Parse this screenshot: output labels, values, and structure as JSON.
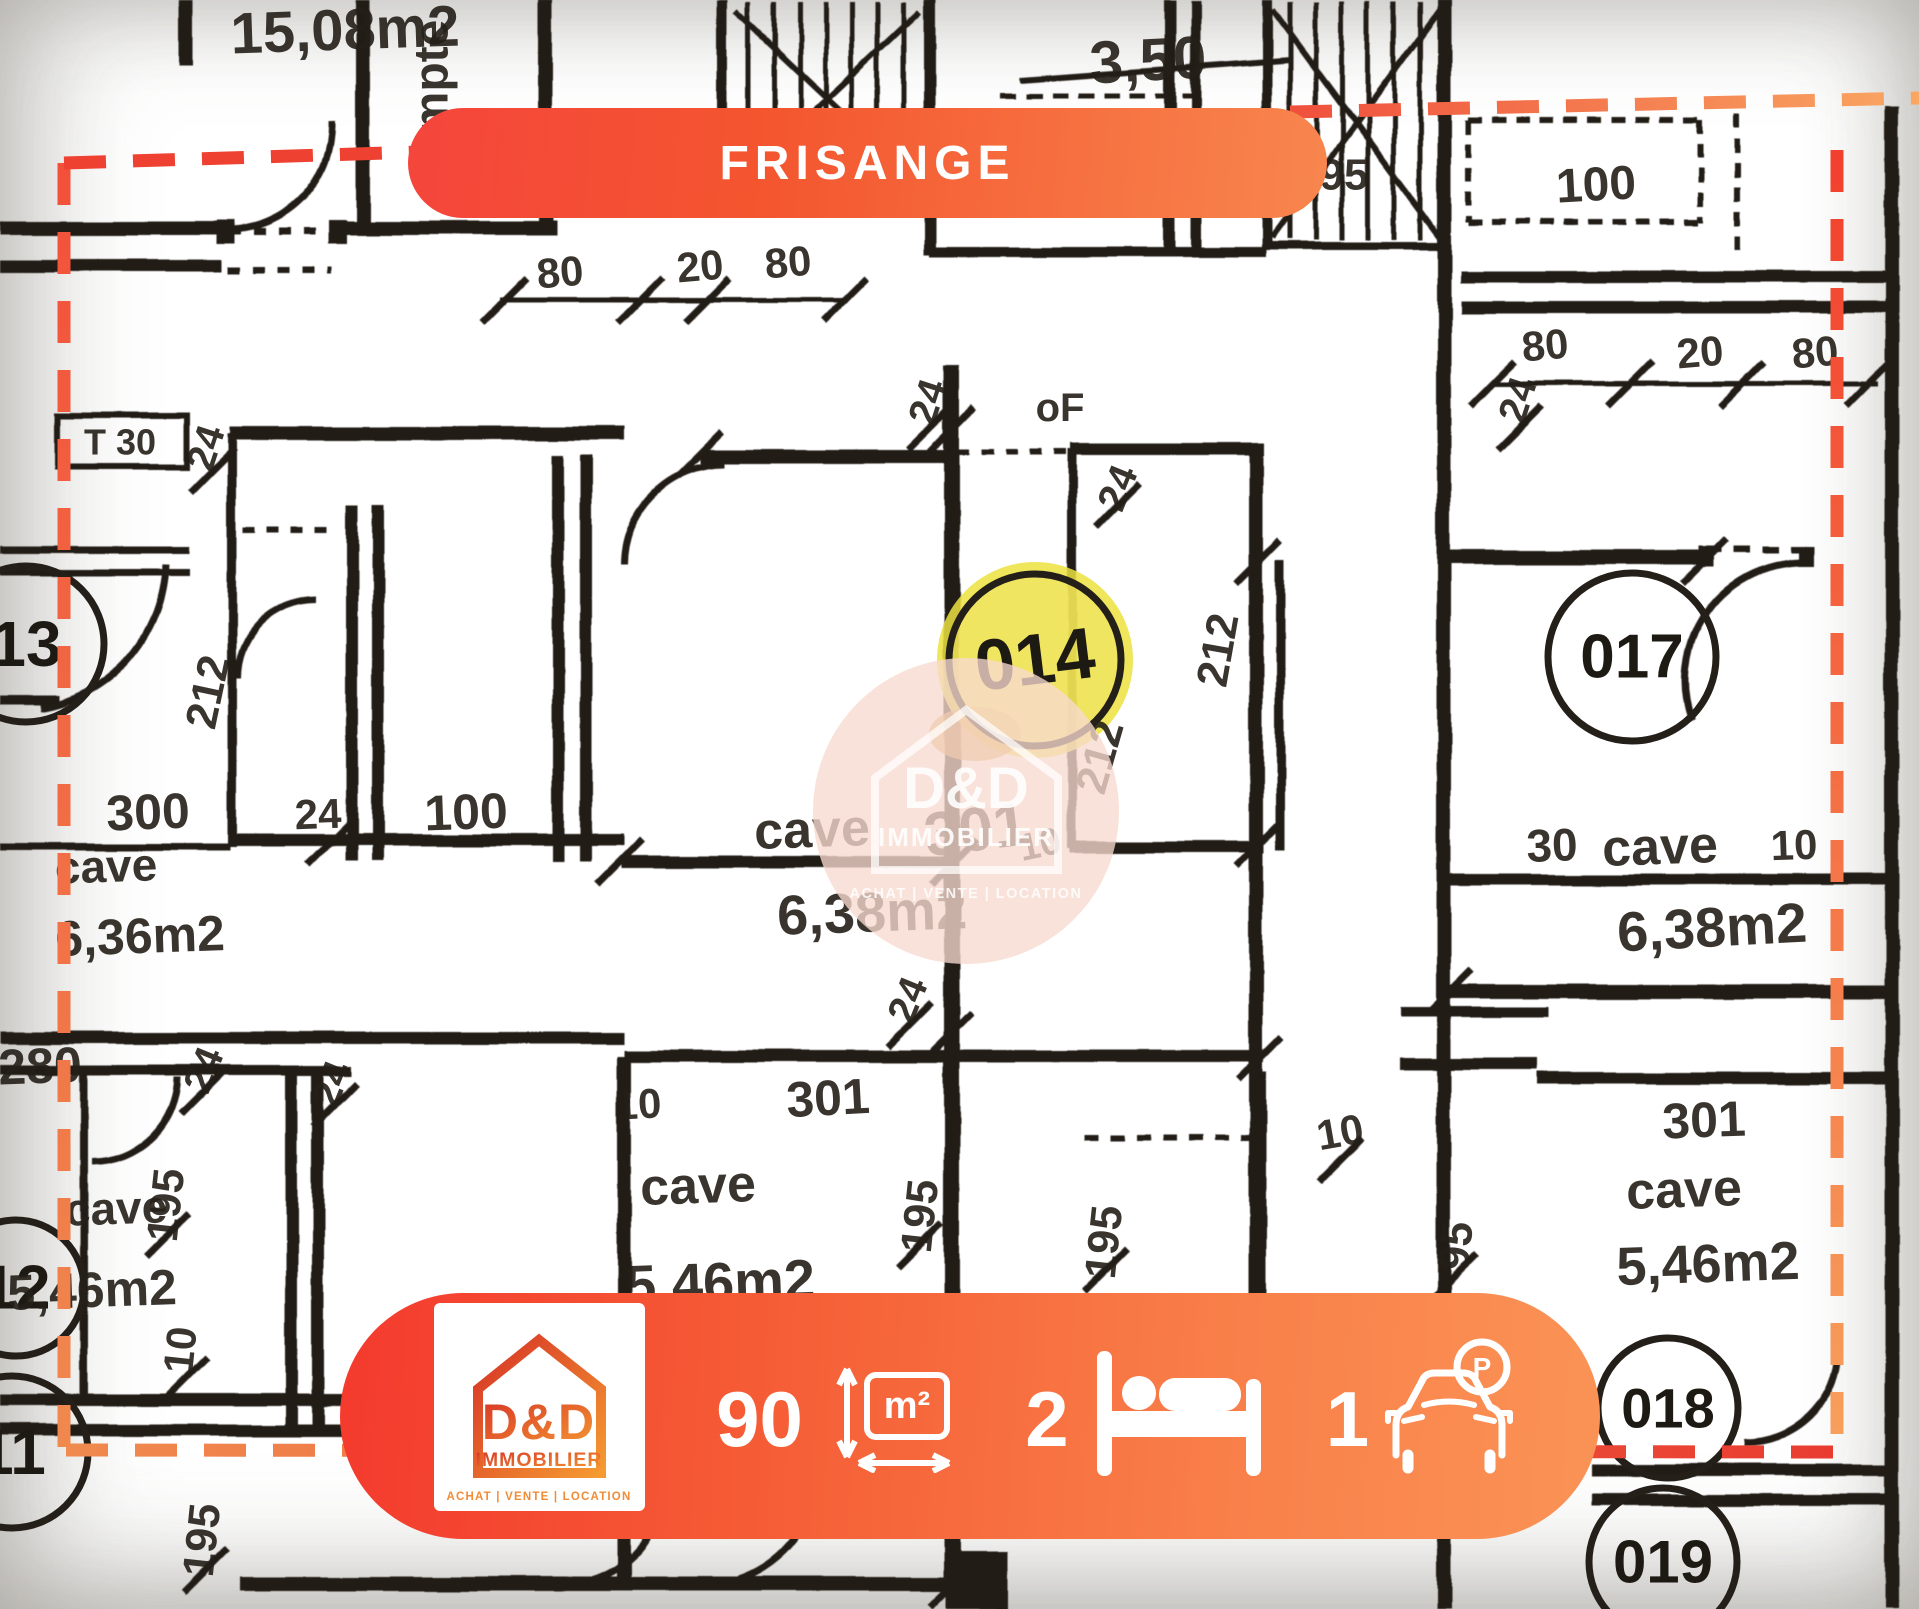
{
  "location_banner": {
    "label": "FRISANGE"
  },
  "property_stats": {
    "area_value": "90",
    "area_unit": "m²",
    "bedrooms_value": "2",
    "parking_value": "1",
    "parking_badge": "P"
  },
  "watermark": {
    "brand": "D&D",
    "brand_sub": "IMMOBILIER",
    "tagline": "ACHAT  |  VENTE  |  LOCATION"
  },
  "agency_card": {
    "brand": "D&D",
    "brand_sub": "IMMOBILIER",
    "tagline": "ACHAT  |  VENTE  |  LOCATION"
  },
  "colors": {
    "accent_red": "#f4392d",
    "accent_orange": "#f8854d",
    "highlight_yellow": "#ece23f",
    "paper": "#ded9cd",
    "ink": "#241f18",
    "dash_red": "#ee4132",
    "dash_orange": "#f79c5c"
  },
  "floor_plan": {
    "room_circles": [
      {
        "label": "13",
        "cx": 26,
        "cy": 644,
        "r": 78,
        "ts": 64
      },
      {
        "label": "12",
        "cx": 16,
        "cy": 1288,
        "r": 68,
        "ts": 62
      },
      {
        "label": "11",
        "cx": 12,
        "cy": 1452,
        "r": 76,
        "ts": 64
      },
      {
        "label": "014",
        "cx": 1035,
        "cy": 660,
        "r": 86,
        "ts": 72,
        "rot": -7,
        "highlight": true
      },
      {
        "label": "017",
        "cx": 1632,
        "cy": 657,
        "r": 84,
        "ts": 62
      },
      {
        "label": "018",
        "cx": 1668,
        "cy": 1408,
        "r": 70,
        "ts": 56
      },
      {
        "label": "019",
        "cx": 1663,
        "cy": 1562,
        "r": 74,
        "ts": 60
      }
    ],
    "labels": [
      {
        "t": "15,08m2",
        "x": 345,
        "y": 30,
        "s": 58,
        "r": -2
      },
      {
        "t": "compte",
        "x": 432,
        "y": 105,
        "s": 48,
        "r": -90
      },
      {
        "t": "3,50",
        "x": 1148,
        "y": 60,
        "s": 60,
        "r": -3
      },
      {
        "t": "95",
        "x": 1344,
        "y": 175,
        "s": 44,
        "r": 0
      },
      {
        "t": "100",
        "x": 1596,
        "y": 185,
        "s": 48,
        "r": -3
      },
      {
        "t": "80",
        "x": 560,
        "y": 272,
        "s": 42,
        "r": -5
      },
      {
        "t": "20",
        "x": 700,
        "y": 266,
        "s": 42,
        "r": -5
      },
      {
        "t": "80",
        "x": 788,
        "y": 262,
        "s": 42,
        "r": -5
      },
      {
        "t": "80",
        "x": 1545,
        "y": 345,
        "s": 42,
        "r": -5
      },
      {
        "t": "20",
        "x": 1700,
        "y": 352,
        "s": 42,
        "r": -5
      },
      {
        "t": "80",
        "x": 1815,
        "y": 352,
        "s": 42,
        "r": -5
      },
      {
        "t": "T 30",
        "x": 120,
        "y": 442,
        "s": 36,
        "r": 0
      },
      {
        "t": "24",
        "x": 206,
        "y": 448,
        "s": 40,
        "r": -72
      },
      {
        "t": "24",
        "x": 928,
        "y": 402,
        "s": 40,
        "r": -72
      },
      {
        "t": "oF",
        "x": 1060,
        "y": 408,
        "s": 40,
        "r": 0
      },
      {
        "t": "24",
        "x": 1118,
        "y": 488,
        "s": 40,
        "r": -68
      },
      {
        "t": "24",
        "x": 1518,
        "y": 400,
        "s": 40,
        "r": -72
      },
      {
        "t": "212",
        "x": 208,
        "y": 692,
        "s": 44,
        "r": -78
      },
      {
        "t": "212",
        "x": 1100,
        "y": 757,
        "s": 44,
        "r": -74
      },
      {
        "t": "212",
        "x": 1218,
        "y": 650,
        "s": 44,
        "r": -80
      },
      {
        "t": "300",
        "x": 148,
        "y": 812,
        "s": 50,
        "r": -2
      },
      {
        "t": "24",
        "x": 318,
        "y": 814,
        "s": 42,
        "r": -2
      },
      {
        "t": "100",
        "x": 466,
        "y": 812,
        "s": 50,
        "r": -2
      },
      {
        "t": "cave",
        "x": 812,
        "y": 830,
        "s": 52,
        "r": -2
      },
      {
        "t": "301",
        "x": 976,
        "y": 830,
        "s": 62,
        "r": -7
      },
      {
        "t": "10",
        "x": 1040,
        "y": 845,
        "s": 38,
        "r": -12
      },
      {
        "t": "6,38m2",
        "x": 872,
        "y": 912,
        "s": 56,
        "r": -2
      },
      {
        "t": "cave",
        "x": 106,
        "y": 866,
        "s": 46,
        "r": -2
      },
      {
        "t": "6,36m2",
        "x": 140,
        "y": 936,
        "s": 50,
        "r": -2
      },
      {
        "t": "30",
        "x": 1552,
        "y": 845,
        "s": 46,
        "r": -2
      },
      {
        "t": "cave",
        "x": 1660,
        "y": 847,
        "s": 52,
        "r": -2
      },
      {
        "t": "10",
        "x": 1794,
        "y": 845,
        "s": 42,
        "r": -2
      },
      {
        "t": "6,38m2",
        "x": 1712,
        "y": 927,
        "s": 56,
        "r": -3
      },
      {
        "t": "280",
        "x": 40,
        "y": 1066,
        "s": 50,
        "r": -2
      },
      {
        "t": "24",
        "x": 204,
        "y": 1070,
        "s": 40,
        "r": -68
      },
      {
        "t": "24",
        "x": 332,
        "y": 1084,
        "s": 40,
        "r": -68
      },
      {
        "t": "24",
        "x": 908,
        "y": 1000,
        "s": 40,
        "r": -68
      },
      {
        "t": "10",
        "x": 638,
        "y": 1104,
        "s": 42,
        "r": -3
      },
      {
        "t": "301",
        "x": 828,
        "y": 1098,
        "s": 50,
        "r": -3
      },
      {
        "t": "10",
        "x": 1340,
        "y": 1132,
        "s": 42,
        "r": -10
      },
      {
        "t": "cave",
        "x": 698,
        "y": 1186,
        "s": 52,
        "r": -2
      },
      {
        "t": "195",
        "x": 920,
        "y": 1216,
        "s": 44,
        "r": -84
      },
      {
        "t": "5,46m2",
        "x": 720,
        "y": 1282,
        "s": 56,
        "r": -2
      },
      {
        "t": "195",
        "x": 1104,
        "y": 1242,
        "s": 44,
        "r": -84
      },
      {
        "t": "95",
        "x": 1456,
        "y": 1246,
        "s": 44,
        "r": -84
      },
      {
        "t": "301",
        "x": 1704,
        "y": 1120,
        "s": 50,
        "r": -2
      },
      {
        "t": "cave",
        "x": 1684,
        "y": 1190,
        "s": 52,
        "r": -2
      },
      {
        "t": "5,46m2",
        "x": 1708,
        "y": 1264,
        "s": 54,
        "r": -2
      },
      {
        "t": "cave",
        "x": 116,
        "y": 1208,
        "s": 46,
        "r": -2
      },
      {
        "t": "195",
        "x": 166,
        "y": 1205,
        "s": 44,
        "r": -84
      },
      {
        "t": "5,46m2",
        "x": 92,
        "y": 1290,
        "s": 50,
        "r": -2
      },
      {
        "t": "10",
        "x": 180,
        "y": 1350,
        "s": 42,
        "r": -84
      },
      {
        "t": "195",
        "x": 202,
        "y": 1540,
        "s": 44,
        "r": -84
      }
    ]
  }
}
